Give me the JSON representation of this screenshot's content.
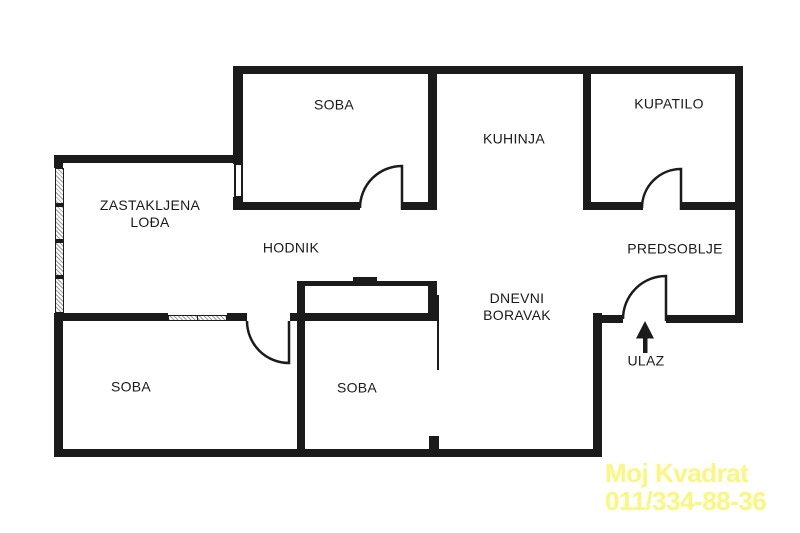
{
  "title": "Apartment floor plan",
  "rooms": [
    {
      "id": "soba-top",
      "label": "SOBA"
    },
    {
      "id": "kuhinja",
      "label": "KUHINJA"
    },
    {
      "id": "kupatilo",
      "label": "KUPATILO"
    },
    {
      "id": "zastakljena-lodja",
      "label": "ZASTAKLJENA\nLOĐA"
    },
    {
      "id": "hodnik",
      "label": "HODNIK"
    },
    {
      "id": "predsoblje",
      "label": "PREDSOBLJE"
    },
    {
      "id": "dnevni-boravak",
      "label": "DNEVNI\nBORAVAK"
    },
    {
      "id": "soba-bottom-left",
      "label": "SOBA"
    },
    {
      "id": "soba-bottom-middle",
      "label": "SOBA"
    },
    {
      "id": "ulaz",
      "label": "ULAZ"
    }
  ],
  "watermark": {
    "line1": "Moj Kvadrat",
    "line2": "011/334-88-36",
    "color": "#fbf77d"
  },
  "colors": {
    "wall": "#1b1b1b",
    "background": "#ffffff",
    "label_text": "#1a1a1a"
  }
}
